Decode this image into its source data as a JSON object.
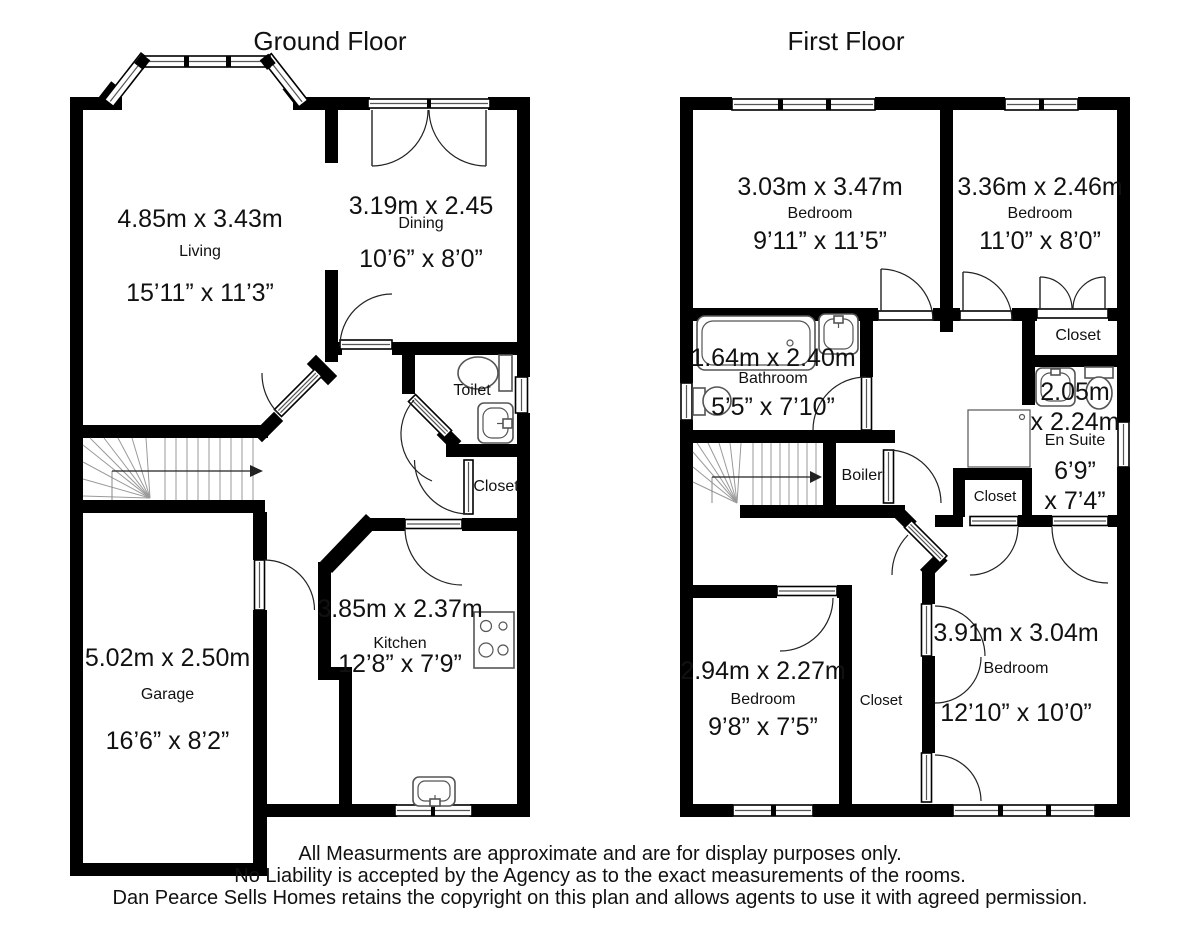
{
  "page": {
    "background": "#ffffff",
    "ink": "#000000"
  },
  "floors": [
    {
      "title": "Ground Floor",
      "rooms": [
        {
          "name": "Living",
          "metric": "4.85m x 3.43m",
          "imperial": "15’11” x 11’3”"
        },
        {
          "name": "Dining",
          "metric": "3.19m x 2.45",
          "imperial": "10’6” x 8’0”"
        },
        {
          "name": "Toilet"
        },
        {
          "name": "Closet"
        },
        {
          "name": "Kitchen",
          "metric": "3.85m x 2.37m",
          "imperial": "12’8” x 7’9”"
        },
        {
          "name": "Garage",
          "metric": "5.02m x 2.50m",
          "imperial": "16’6” x 8’2”"
        }
      ]
    },
    {
      "title": "First Floor",
      "rooms": [
        {
          "name": "Bedroom",
          "metric": "3.03m x 3.47m",
          "imperial": "9’11” x 11’5”"
        },
        {
          "name": "Bedroom",
          "metric": "3.36m x 2.46m",
          "imperial": "11’0” x 8’0”"
        },
        {
          "name": "Closet"
        },
        {
          "name": "Bathroom",
          "metric": "1.64m x 2.40m",
          "imperial": "5’5” x 7’10”"
        },
        {
          "name": "En Suite",
          "metric_line1": "2.05m",
          "metric_line2": "x 2.24m",
          "imperial_line1": "6’9”",
          "imperial_line2": "x 7’4”"
        },
        {
          "name": "Boiler"
        },
        {
          "name": "Closet"
        },
        {
          "name": "Bedroom",
          "metric": "2.94m x 2.27m",
          "imperial": "9’8” x 7’5”"
        },
        {
          "name": "Closet"
        },
        {
          "name": "Bedroom",
          "metric": "3.91m x 3.04m",
          "imperial": "12’10” x 10’0”"
        }
      ]
    }
  ],
  "footer": {
    "line1": "All Measurments are approximate and are for display purposes only.",
    "line2": "No Liability is accepted by the Agency as to the exact measurements of the rooms.",
    "line3": "Dan Pearce Sells Homes retains the copyright on this plan and allows agents to use it with agreed permission."
  }
}
